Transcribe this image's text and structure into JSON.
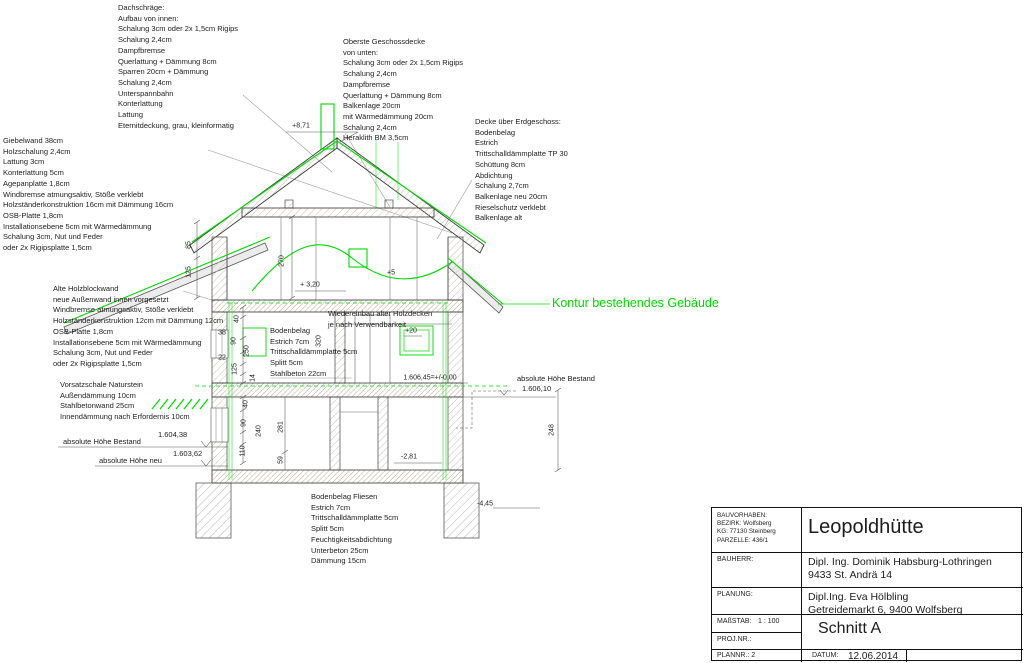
{
  "drawing": {
    "colors": {
      "accent_green": "#00d800",
      "line": "#2b2b2b",
      "secondary": "#666666"
    },
    "blocks": {
      "dachschraege": {
        "lines": [
          "Dachschräge:",
          "Aufbau von innen:",
          "Schalung 3cm oder 2x 1,5cm Rigips",
          "Schalung 2,4cm",
          "Dampfbremse",
          "Querlattung + Dämmung 8cm",
          "Sparren 20cm + Dämmung",
          "Schalung 2,4cm",
          "Unterspannbahn",
          "Konterlattung",
          "Lattung",
          "Eternitdeckung, grau, kleinformatig"
        ]
      },
      "oberste_decke": {
        "lines": [
          "Oberste Geschossdecke",
          "von unten:",
          "Schalung 3cm oder 2x 1,5cm Rigips",
          "Schalung 2,4cm",
          "Dampfbremse",
          "Querlattung + Dämmung 8cm",
          "Balkenlage 20cm",
          "mit Wärmedämmung 20cm",
          "Schalung 2,4cm",
          "Heraklith BM 3,5cm"
        ]
      },
      "decke_eg": {
        "lines": [
          "Decke über Erdgeschoss:",
          "Bodenbelag",
          "Estrich",
          "Trittschalldämmplatte TP 30",
          "Schüttung 8cm",
          "Abdichtung",
          "Schalung 2,7cm",
          "Balkenlage neu 20cm",
          "Rieselschutz verklebt",
          "Balkenlage alt"
        ]
      },
      "giebelwand": {
        "lines": [
          "Giebelwand 38cm",
          "Holzschalung 2,4cm",
          "Lattung 3cm",
          "Konterlattung 5cm",
          "Agepanplatte 1,8cm",
          "Windbremse atmungsaktiv, Stöße verklebt",
          "Holzständerkonstruktion 16cm mit Dämmung 16cm",
          "OSB-Platte 1,8cm",
          "Installationsebene 5cm mit Wärmedämmung",
          "Schalung 3cm, Nut und Feder",
          "oder 2x Rigipsplatte 1,5cm"
        ]
      },
      "holzblockwand": {
        "lines": [
          "Alte Holzblockwand",
          "neue Außenwand innen vorgesetzt",
          "Windbremse atmungsaktiv, Stöße verklebt",
          "Holzständerkonstruktion 12cm mit Dämmung 12cm",
          "OSB-Platte 1,8cm",
          "Installationsebene 5cm mit Wärmedämmung",
          "Schalung 3cm, Nut und Feder",
          "oder 2x Rigipsplatte 1,5cm"
        ]
      },
      "vorsatzschale": {
        "lines": [
          "Vorsatzschale Naturstein",
          "Außendämmung 10cm",
          "Stahlbetonwand 25cm",
          "Innendämmung nach Erfordernis 10cm"
        ]
      },
      "bodenbelag_og": {
        "lines": [
          "Bodenbelag",
          "Estrich 7cm",
          "Trittschalldämmplatte 5cm",
          "Splitt 5cm",
          "Stahlbeton 22cm"
        ]
      },
      "wiedereinbau": {
        "lines": [
          "Wiedereinbau alter Holzdecken",
          "je nach Verwendbarkeit"
        ]
      },
      "bodenbelag_eg": {
        "lines": [
          "Bodenbelag Fliesen",
          "Estrich 7cm",
          "Trittschalldämmplatte 5cm",
          "Splitt 5cm",
          "Feuchtigkeitsabdichtung",
          "Unterbeton 25cm",
          "Dämmung 15cm"
        ]
      }
    },
    "kontur_label": "Kontur bestehendes Gebäude",
    "levels": [
      {
        "label": "absolute Höhe Bestand",
        "value": "1.604,38",
        "lx": 63,
        "ly": 437,
        "vx": 158,
        "vy": 430
      },
      {
        "label": "absolute Höhe neu",
        "value": "1.603,62",
        "lx": 99,
        "ly": 456,
        "vx": 173,
        "vy": 449
      },
      {
        "label": "absolute Höhe Bestand",
        "value": "1.606,10",
        "lx": 517,
        "ly": 374,
        "vx": 522,
        "vy": 384
      }
    ],
    "dims": [
      {
        "text": "+8,71",
        "x": 301,
        "y": 126,
        "rot": false
      },
      {
        "text": "85",
        "x": 189,
        "y": 245,
        "rot": true
      },
      {
        "text": "125",
        "x": 189,
        "y": 272,
        "rot": true
      },
      {
        "text": "270",
        "x": 282,
        "y": 261,
        "rot": true
      },
      {
        "text": "+5",
        "x": 391,
        "y": 273,
        "rot": false
      },
      {
        "text": "+ 3,20",
        "x": 310,
        "y": 285,
        "rot": false
      },
      {
        "text": "40",
        "x": 237,
        "y": 319,
        "rot": true
      },
      {
        "text": "38",
        "x": 222,
        "y": 333,
        "rot": false
      },
      {
        "text": "90",
        "x": 234,
        "y": 341,
        "rot": true
      },
      {
        "text": "250",
        "x": 247,
        "y": 351,
        "rot": true
      },
      {
        "text": "22",
        "x": 222,
        "y": 358,
        "rot": false
      },
      {
        "text": "125",
        "x": 235,
        "y": 369,
        "rot": true
      },
      {
        "text": "14",
        "x": 253,
        "y": 378,
        "rot": true
      },
      {
        "text": "320",
        "x": 319,
        "y": 341,
        "rot": true
      },
      {
        "text": "+20",
        "x": 411,
        "y": 331,
        "rot": false
      },
      {
        "text": "1.606,45=+/-0,00",
        "x": 430,
        "y": 378,
        "rot": false
      },
      {
        "text": "40",
        "x": 246,
        "y": 404,
        "rot": true
      },
      {
        "text": "90",
        "x": 244,
        "y": 423,
        "rot": true
      },
      {
        "text": "240",
        "x": 259,
        "y": 431,
        "rot": true
      },
      {
        "text": "110",
        "x": 243,
        "y": 451,
        "rot": true
      },
      {
        "text": "281",
        "x": 281,
        "y": 427,
        "rot": true
      },
      {
        "text": "59",
        "x": 281,
        "y": 460,
        "rot": true
      },
      {
        "text": "248",
        "x": 552,
        "y": 430,
        "rot": true
      },
      {
        "text": "-2,81",
        "x": 409,
        "y": 457,
        "rot": false
      },
      {
        "text": "-4,45",
        "x": 485,
        "y": 504,
        "rot": false
      }
    ]
  },
  "title_block": {
    "bauvorhaben": "BAUVORHABEN:\nBEZIRK: Wolfsberg\nKG: 77130 Steinberg\nPARZELLE: 436/1",
    "project_title": "Leopoldhütte",
    "bauherr_label": "BAUHERR:",
    "bauherr": "Dipl. Ing. Dominik Habsburg-Lothringen\n9433 St. Andrä 14",
    "planung_label": "PLANUNG:",
    "planung": "Dipl.Ing. Eva Hölbling\nGetreidemarkt 6, 9400 Wolfsberg",
    "massstab_label": "MAßSTAB:",
    "massstab_value": "1 : 100",
    "projnr_label": "PROJ.NR.:",
    "plannr_label": "PLANNR.: 2",
    "sheet_title": "Schnitt A",
    "datum_label": "DATUM:",
    "datum_value": "12.06.2014"
  }
}
